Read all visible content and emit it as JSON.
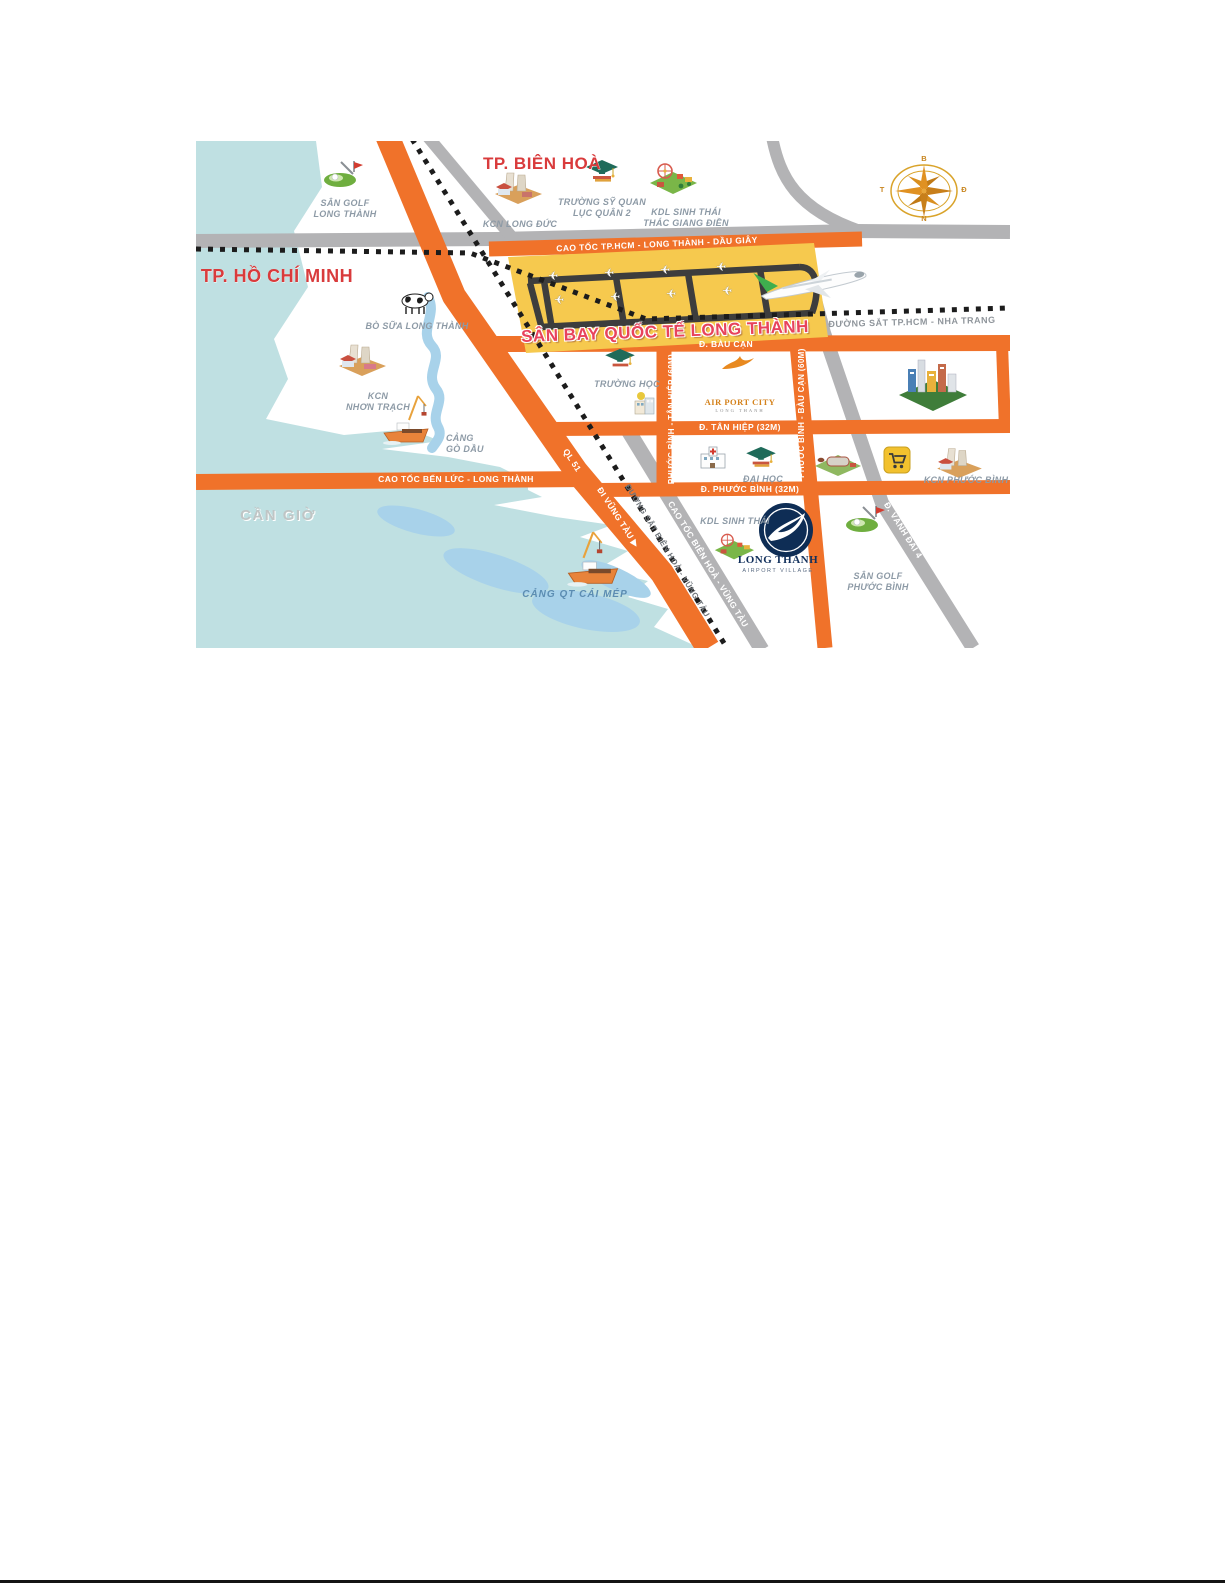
{
  "city_labels": {
    "bien_hoa": "TP. BIÊN HOÀ",
    "ho_chi_minh": "TP. HỒ CHÍ MINH",
    "can_gio": "CẦN GIỜ"
  },
  "airport": {
    "name": "SÂN BAY QUỐC TẾ LONG THÀNH"
  },
  "roads": {
    "cao_toc_hcm": "CAO TỐC TP.HCM - LONG THÀNH - DẦU GIÂY",
    "bau_can": "Đ. BÀU CẠN",
    "tan_hiep": "Đ. TÂN HIỆP (32M)",
    "phuoc_binh": "Đ. PHƯỚC BÌNH (32M)",
    "pb_tan_hiep": "PHƯỚC BÌNH - TÂN HIỆP (60M)",
    "pb_bau_can": "PHƯỚC BÌNH - BÀU CẠN (60M)",
    "ben_luc": "CAO TỐC BẾN LỨC - LONG THÀNH",
    "ql51": "QL 51",
    "di_vung_tau": "ĐI VŨNG TÀU ▶",
    "ct_bien_hoa_vt": "CAO TỐC BIÊN HOÀ - VŨNG TÀU",
    "vanh_dai_4": "Đ. VÀNH ĐAI 4"
  },
  "railways": {
    "hcm_nha_trang": "ĐƯỜNG SẮT TP.HCM - NHA TRANG",
    "bien_hoa_vt": "ĐƯỜNG SẮT BIÊN HOÀ - VŨNG TÀU"
  },
  "pois": {
    "san_golf_long_thanh": "SÂN GOLF\nLONG THÀNH",
    "kcn_long_duc": "KCN LONG ĐỨC",
    "truong_sy_quan": "TRƯỜNG SỸ QUAN\nLỤC QUÂN 2",
    "kdl_thac_giang_dien": "KDL SINH THÁI\nTHÁC GIANG ĐIỀN",
    "bo_sua_long_thanh": "BÒ SỮA LONG THÀNH",
    "kcn_nhon_trach": "KCN\nNHƠN TRẠCH",
    "cang_go_dau": "CẢNG\nGÒ DẦU",
    "truong_hoc": "TRƯỜNG HỌC",
    "dai_hoc": "ĐẠI HỌC",
    "kcn_phuoc_binh": "KCN PHƯỚC BÌNH",
    "kdl_sinh_thai": "KDL SINH THÁI",
    "san_golf_phuoc_binh": "SÂN GOLF\nPHƯỚC BÌNH",
    "cang_qt_cai_mep": "CẢNG QT CÁI MÉP"
  },
  "logos": {
    "airport_city": {
      "line1": "AIR PORT CITY",
      "line2": "LONG THANH"
    },
    "airport_village": {
      "line1": "LONG THÀNH",
      "line2": "AIRPORT VILLAGE"
    }
  },
  "compass": {
    "north": "B",
    "east": "Đ",
    "south": "N",
    "west": "T"
  },
  "colors": {
    "road_orange": "#f0722a",
    "road_gray": "#b3b3b5",
    "railway_black": "#1c1c1c",
    "water": "#bfe0e2",
    "water_channel": "#a8d2ea",
    "airport_yellow": "#f6c94e",
    "runway_gray": "#3d3d3d",
    "label_red": "#d93b3c",
    "poi_gray": "#8d9aa6",
    "logo_navy": "#0e2d55"
  }
}
